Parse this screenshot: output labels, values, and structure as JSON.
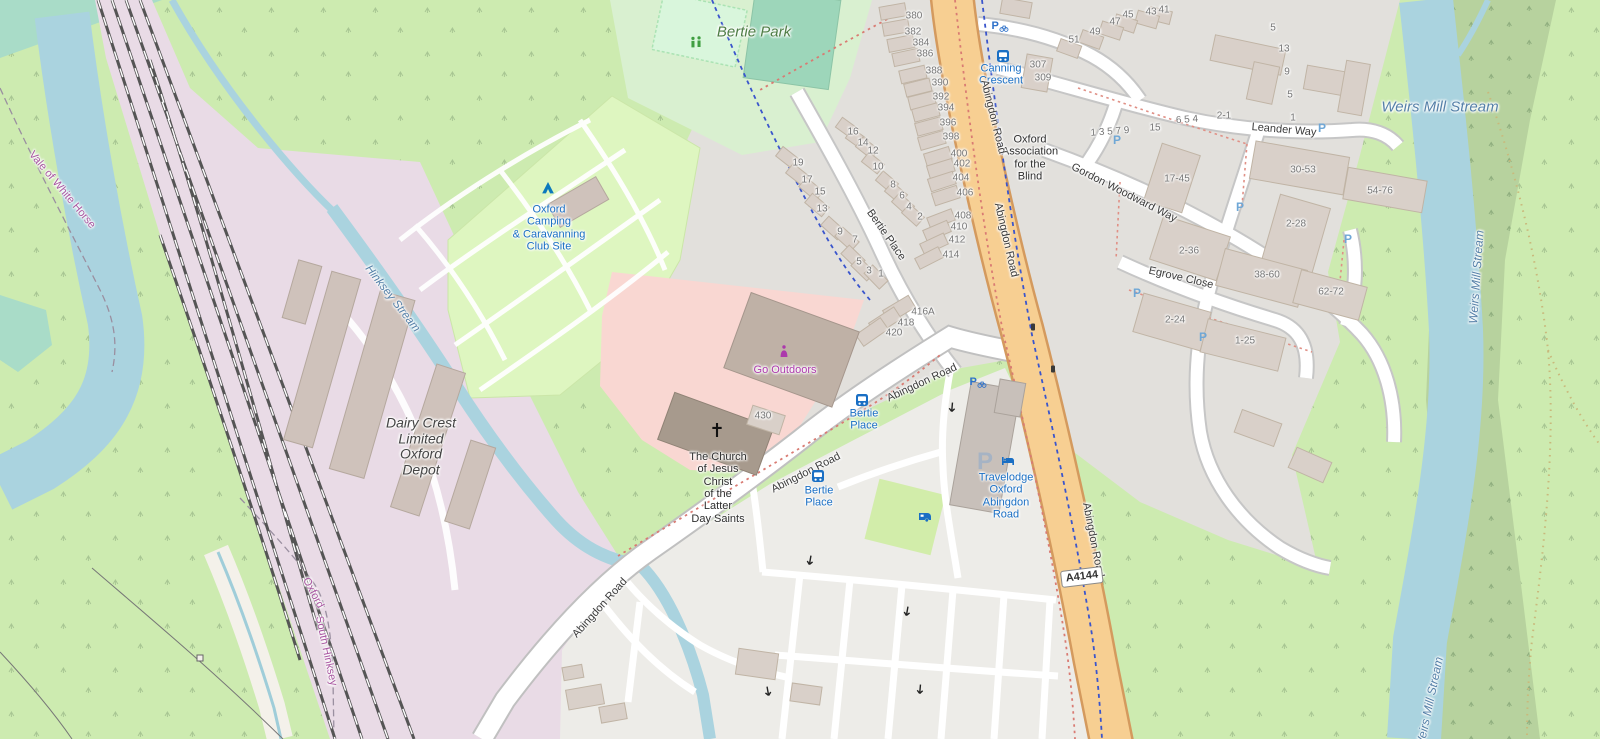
{
  "map": {
    "road_ref": "A4144",
    "colors": {
      "water": "#aad3df",
      "water_label": "#5580a8",
      "main_road": "#f7cf92",
      "residential_grey": "#e2e0dc",
      "retail_pink": "#f9d7d2",
      "camp_green": "#def6c0",
      "park_green": "#d9f0d0",
      "railway_lavender": "#e9dbe6",
      "grass": "#cdebb0",
      "woods": "#b7d29e",
      "poi_blue": "#1a6fc4",
      "shop_purple": "#ac39ac",
      "boundary_purple": "#a855a0"
    },
    "labels": [
      {
        "n": "weirs-mill-stream-label",
        "c": "water",
        "t": "Weirs Mill Stream",
        "x": 1440,
        "y": 108,
        "r": 0,
        "s": 15
      },
      {
        "n": "weirs-mill-stream-label-vertical",
        "c": "water",
        "t": "Weirs Mill Stream",
        "x": 1477,
        "y": 277,
        "r": -86,
        "s": 12
      },
      {
        "n": "weirs-mill-stream-label-bottom",
        "c": "water",
        "t": "Weirs Mill Stream",
        "x": 1430,
        "y": 703,
        "r": -78,
        "s": 12
      },
      {
        "n": "hinksey-stream-label",
        "c": "water",
        "t": "Hinksey Stream",
        "x": 392,
        "y": 299,
        "r": 52,
        "s": 11.5
      },
      {
        "n": "vale-of-white-horse-label",
        "c": "bnd",
        "t": "Vale of White Horse",
        "x": 62,
        "y": 190,
        "r": 50,
        "s": 11
      },
      {
        "n": "oxford-boundary-label",
        "c": "bnd",
        "t": "Oxford",
        "x": 313,
        "y": 593,
        "r": 62,
        "s": 11
      },
      {
        "n": "south-hinksey-label",
        "c": "bnd",
        "t": "South Hinksey",
        "x": 326,
        "y": 651,
        "r": 78,
        "s": 11
      },
      {
        "n": "bertie-park-label",
        "c": "parklbl",
        "t": "Bertie Park",
        "x": 754,
        "y": 33,
        "r": 0,
        "s": 15
      },
      {
        "n": "camping-site-label",
        "c": "poiblue",
        "t": "Oxford\nCamping\n& Caravanning\nClub Site",
        "x": 549,
        "y": 228,
        "r": 0,
        "s": 11
      },
      {
        "n": "travelodge-label",
        "c": "poiblue",
        "t": "Travelodge\nOxford\nAbingdon\nRoad",
        "x": 1006,
        "y": 496,
        "r": 0,
        "s": 11
      },
      {
        "n": "bertie-place-stop-label-1",
        "c": "poiblue",
        "t": "Bertie\nPlace",
        "x": 864,
        "y": 420,
        "r": 0,
        "s": 11
      },
      {
        "n": "bertie-place-stop-label-2",
        "c": "poiblue",
        "t": "Bertie\nPlace",
        "x": 819,
        "y": 497,
        "r": 0,
        "s": 11
      },
      {
        "n": "canning-crescent-stop-label",
        "c": "poiblue",
        "t": "Canning\nCrescent",
        "x": 1001,
        "y": 75,
        "r": 0,
        "s": 11
      },
      {
        "n": "dairy-crest-label",
        "c": "poidark dairy",
        "t": "Dairy Crest\nLimited\nOxford\nDepot",
        "x": 421,
        "y": 447,
        "r": 0,
        "s": 14
      },
      {
        "n": "lds-church-label",
        "c": "poidark",
        "t": "The Church\nof Jesus\nChrist\nof the\nLatter\nDay Saints",
        "x": 718,
        "y": 488,
        "r": 0,
        "s": 11
      },
      {
        "n": "oxford-association-blind-label",
        "c": "poidark",
        "t": "Oxford\nAssociation\nfor the\nBlind",
        "x": 1030,
        "y": 158,
        "r": 0,
        "s": 11
      },
      {
        "n": "go-outdoors-label",
        "c": "shoplbl",
        "t": "Go Outdoors",
        "x": 785,
        "y": 370,
        "r": 0,
        "s": 11
      },
      {
        "n": "abingdon-road-label-1",
        "c": "street",
        "t": "Abingdon Road",
        "x": 993,
        "y": 117,
        "r": 76,
        "s": 11
      },
      {
        "n": "abingdon-road-label-2",
        "c": "street",
        "t": "Abingdon Road",
        "x": 1006,
        "y": 240,
        "r": 77,
        "s": 11
      },
      {
        "n": "abingdon-road-label-3",
        "c": "street",
        "t": "Abingdon Road",
        "x": 1093,
        "y": 540,
        "r": 79,
        "s": 11
      },
      {
        "n": "abingdon-road-label-4",
        "c": "street",
        "t": "Abingdon Road",
        "x": 922,
        "y": 383,
        "r": -25,
        "s": 11
      },
      {
        "n": "abingdon-road-label-5",
        "c": "street",
        "t": "Abingdon Road",
        "x": 806,
        "y": 473,
        "r": -27,
        "s": 11
      },
      {
        "n": "abingdon-road-label-6",
        "c": "street",
        "t": "Abingdon Road",
        "x": 600,
        "y": 608,
        "r": -48,
        "s": 11
      },
      {
        "n": "bertie-place-street-label",
        "c": "street",
        "t": "Bertie Place",
        "x": 886,
        "y": 235,
        "r": 55,
        "s": 11
      },
      {
        "n": "leander-way-label",
        "c": "street",
        "t": "Leander Way",
        "x": 1284,
        "y": 130,
        "r": 5,
        "s": 11
      },
      {
        "n": "gordon-woodward-way-label",
        "c": "street",
        "t": "Gordon Woodward Way",
        "x": 1124,
        "y": 193,
        "r": 27,
        "s": 11
      },
      {
        "n": "egrove-close-label",
        "c": "street",
        "t": "Egrove Close",
        "x": 1181,
        "y": 278,
        "r": 13,
        "s": 11
      }
    ],
    "house_numbers": [
      {
        "t": "380",
        "x": 914,
        "y": 16
      },
      {
        "t": "382",
        "x": 913,
        "y": 32
      },
      {
        "t": "384",
        "x": 921,
        "y": 43
      },
      {
        "t": "386",
        "x": 925,
        "y": 54
      },
      {
        "t": "388",
        "x": 934,
        "y": 71
      },
      {
        "t": "390",
        "x": 940,
        "y": 83
      },
      {
        "t": "392",
        "x": 941,
        "y": 97
      },
      {
        "t": "394",
        "x": 946,
        "y": 108
      },
      {
        "t": "396",
        "x": 948,
        "y": 123
      },
      {
        "t": "398",
        "x": 951,
        "y": 137
      },
      {
        "t": "400",
        "x": 959,
        "y": 154
      },
      {
        "t": "402",
        "x": 962,
        "y": 164
      },
      {
        "t": "404",
        "x": 961,
        "y": 178
      },
      {
        "t": "406",
        "x": 965,
        "y": 193
      },
      {
        "t": "408",
        "x": 963,
        "y": 216
      },
      {
        "t": "410",
        "x": 959,
        "y": 227
      },
      {
        "t": "412",
        "x": 957,
        "y": 240
      },
      {
        "t": "414",
        "x": 951,
        "y": 255
      },
      {
        "t": "416A",
        "x": 923,
        "y": 312
      },
      {
        "t": "418",
        "x": 906,
        "y": 323
      },
      {
        "t": "420",
        "x": 894,
        "y": 333
      },
      {
        "t": "19",
        "x": 798,
        "y": 163
      },
      {
        "t": "17",
        "x": 807,
        "y": 180
      },
      {
        "t": "15",
        "x": 820,
        "y": 192
      },
      {
        "t": "13",
        "x": 822,
        "y": 209
      },
      {
        "t": "9",
        "x": 840,
        "y": 232
      },
      {
        "t": "7",
        "x": 855,
        "y": 240
      },
      {
        "t": "5",
        "x": 859,
        "y": 262
      },
      {
        "t": "3",
        "x": 869,
        "y": 271
      },
      {
        "t": "1",
        "x": 881,
        "y": 274
      },
      {
        "t": "16",
        "x": 853,
        "y": 132
      },
      {
        "t": "14",
        "x": 863,
        "y": 143
      },
      {
        "t": "12",
        "x": 873,
        "y": 151
      },
      {
        "t": "10",
        "x": 878,
        "y": 167
      },
      {
        "t": "8",
        "x": 893,
        "y": 185
      },
      {
        "t": "6",
        "x": 902,
        "y": 196
      },
      {
        "t": "4",
        "x": 909,
        "y": 207
      },
      {
        "t": "2",
        "x": 920,
        "y": 217
      },
      {
        "t": "41",
        "x": 1164,
        "y": 10
      },
      {
        "t": "43",
        "x": 1151,
        "y": 12
      },
      {
        "t": "45",
        "x": 1128,
        "y": 15
      },
      {
        "t": "47",
        "x": 1115,
        "y": 22
      },
      {
        "t": "49",
        "x": 1095,
        "y": 32
      },
      {
        "t": "51",
        "x": 1074,
        "y": 40
      },
      {
        "t": "307",
        "x": 1038,
        "y": 65
      },
      {
        "t": "309",
        "x": 1043,
        "y": 78
      },
      {
        "t": "1 3 5 7 9",
        "x": 1110,
        "y": 132,
        "r": -4
      },
      {
        "t": "15",
        "x": 1155,
        "y": 128
      },
      {
        "t": "6 5 4",
        "x": 1187,
        "y": 120,
        "r": -4
      },
      {
        "t": "2-1",
        "x": 1224,
        "y": 116
      },
      {
        "t": "5",
        "x": 1273,
        "y": 28
      },
      {
        "t": "13",
        "x": 1284,
        "y": 49
      },
      {
        "t": "9",
        "x": 1287,
        "y": 72
      },
      {
        "t": "5",
        "x": 1290,
        "y": 95
      },
      {
        "t": "1",
        "x": 1293,
        "y": 118
      },
      {
        "t": "17-45",
        "x": 1177,
        "y": 179
      },
      {
        "t": "30-53",
        "x": 1303,
        "y": 170
      },
      {
        "t": "54-76",
        "x": 1380,
        "y": 191
      },
      {
        "t": "2-28",
        "x": 1296,
        "y": 224
      },
      {
        "t": "2-36",
        "x": 1189,
        "y": 251
      },
      {
        "t": "38-60",
        "x": 1267,
        "y": 275
      },
      {
        "t": "62-72",
        "x": 1331,
        "y": 292
      },
      {
        "t": "2-24",
        "x": 1175,
        "y": 320
      },
      {
        "t": "1-25",
        "x": 1245,
        "y": 341
      },
      {
        "t": "430",
        "x": 763,
        "y": 416
      }
    ],
    "icons": [
      {
        "k": "tent",
        "x": 548,
        "y": 188
      },
      {
        "k": "playground",
        "x": 696,
        "y": 42
      },
      {
        "k": "shop",
        "x": 784,
        "y": 351
      },
      {
        "k": "cross",
        "x": 717,
        "y": 430
      },
      {
        "k": "bus",
        "x": 862,
        "y": 400
      },
      {
        "k": "bus",
        "x": 818,
        "y": 476
      },
      {
        "k": "bus",
        "x": 1003,
        "y": 56
      },
      {
        "k": "caravan",
        "x": 925,
        "y": 517
      },
      {
        "k": "bed",
        "x": 1008,
        "y": 461
      },
      {
        "k": "parking-lot",
        "x": 985,
        "y": 462
      },
      {
        "k": "parking-bike",
        "x": 1000,
        "y": 26
      },
      {
        "k": "parking-bike",
        "x": 978,
        "y": 382
      },
      {
        "k": "parking",
        "x": 1117,
        "y": 140
      },
      {
        "k": "parking",
        "x": 1240,
        "y": 207
      },
      {
        "k": "parking",
        "x": 1348,
        "y": 239
      },
      {
        "k": "parking",
        "x": 1137,
        "y": 293
      },
      {
        "k": "parking",
        "x": 1203,
        "y": 337
      },
      {
        "k": "parking",
        "x": 1322,
        "y": 128
      },
      {
        "k": "signal",
        "x": 1033,
        "y": 327
      },
      {
        "k": "signal",
        "x": 1053,
        "y": 369
      },
      {
        "k": "arrow",
        "x": 810,
        "y": 561,
        "r": 100
      },
      {
        "k": "arrow",
        "x": 907,
        "y": 612,
        "r": 100
      },
      {
        "k": "arrow",
        "x": 920,
        "y": 690,
        "r": 95
      },
      {
        "k": "arrow",
        "x": 768,
        "y": 692,
        "r": 80
      },
      {
        "k": "arrow",
        "x": 952,
        "y": 408,
        "r": 95
      }
    ]
  }
}
